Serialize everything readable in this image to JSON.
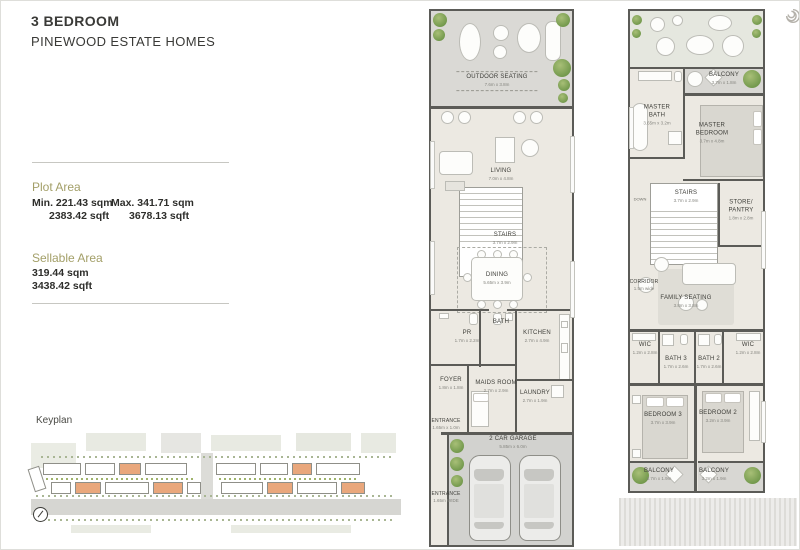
{
  "header": {
    "title": "3 BEDROOM",
    "subtitle": "PINEWOOD ESTATE HOMES"
  },
  "plot_area": {
    "heading": "Plot Area",
    "min_sqm": "Min. 221.43 sqm",
    "min_sqft": "2383.42 sqft",
    "max_sqm": "Max. 341.71 sqm",
    "max_sqft": "3678.13 sqft"
  },
  "sellable_area": {
    "heading": "Sellable Area",
    "sqm": "319.44 sqm",
    "sqft": "3438.42 sqft"
  },
  "keyplan": {
    "label": "Keyplan",
    "compass_icon": "compass-north-circle"
  },
  "logo_icon": "spiral-logo",
  "colors": {
    "accent_olive": "#a39f68",
    "wall": "#5b5b57",
    "floor": "#ece9e2",
    "outdoor_gray": "#dad9d5",
    "terrace_green": "#e5e7df",
    "garage_gray": "#d2d2cf",
    "plant_green": "#5e8a3c",
    "keyplan_orange": "#e9a77c"
  },
  "ground": {
    "name": "ground-floor-plan",
    "rooms": [
      {
        "name": "OUTDOOR SEATING",
        "dim": "7.6m x 3.8m"
      },
      {
        "name": "LIVING",
        "dim": "7.0m x 4.8m"
      },
      {
        "name": "STAIRS",
        "dim": "3.7m x 2.9m"
      },
      {
        "name": "DINING",
        "dim": "5.65m x 3.9m"
      },
      {
        "name": "PR",
        "dim": "1.7m x 2.2m"
      },
      {
        "name": "BATH",
        "dim": ""
      },
      {
        "name": "KITCHEN",
        "dim": "2.7m x 4.9m"
      },
      {
        "name": "FOYER",
        "dim": "1.8m x 1.8m"
      },
      {
        "name": "MAIDS ROOM",
        "dim": "2.7m x 2.9m"
      },
      {
        "name": "LAUNDRY",
        "dim": "2.7m x 1.9m"
      },
      {
        "name": "ENTRANCE",
        "dim": "1.65m x 1.0m"
      },
      {
        "name": "2 CAR GARAGE",
        "dim": "5.85m x 6.0m"
      },
      {
        "name": "ENTRANCE",
        "dim": "1.65m WIDE"
      }
    ]
  },
  "first": {
    "name": "first-floor-plan",
    "stairs_note": "DOWN",
    "rooms": [
      {
        "name": "BALCONY",
        "dim": "3.7m x 1.8m"
      },
      {
        "name": "MASTER BATH",
        "dim": "3.65m x 3.2m"
      },
      {
        "name": "MASTER BEDROOM",
        "dim": "3.7m x 4.8m"
      },
      {
        "name": "STAIRS",
        "dim": "3.7m x 2.9m"
      },
      {
        "name": "STORE/ PANTRY",
        "dim": "1.8m x 2.8m"
      },
      {
        "name": "CORRIDOR",
        "dim": "1.5m wide"
      },
      {
        "name": "FAMILY SEATING",
        "dim": "3.8m x 3.8m"
      },
      {
        "name": "WIC",
        "dim": "1.2m x 2.8m"
      },
      {
        "name": "BATH 3",
        "dim": "1.7m x 2.6m"
      },
      {
        "name": "BATH 2",
        "dim": "1.7m x 2.6m"
      },
      {
        "name": "WIC",
        "dim": "1.2m x 2.8m"
      },
      {
        "name": "BEDROOM 3",
        "dim": "3.7m x 3.9m"
      },
      {
        "name": "BEDROOM 2",
        "dim": "3.2m x 3.9m"
      },
      {
        "name": "BALCONY",
        "dim": "3.7m x 1.9m"
      },
      {
        "name": "BALCONY",
        "dim": "3.2m x 1.9m"
      }
    ]
  }
}
